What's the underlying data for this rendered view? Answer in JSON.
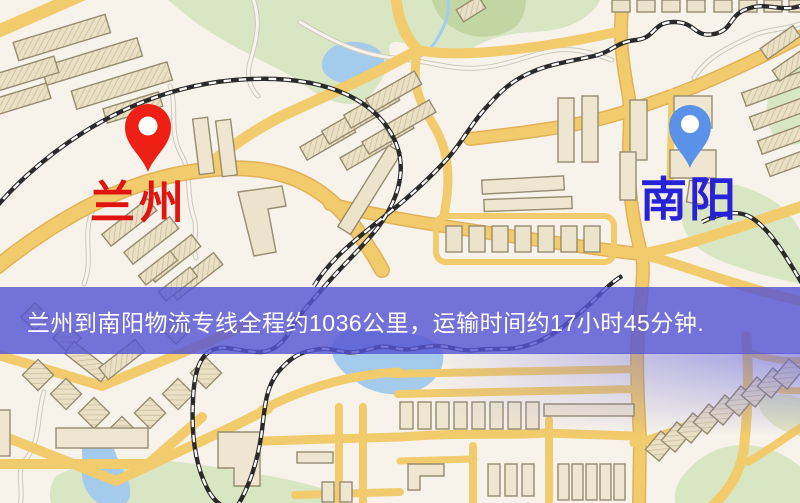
{
  "map": {
    "origin": {
      "label": "兰州",
      "label_color": "#e0150f",
      "pin_color": "#ee2015",
      "pin_icon": "red-location-pin-icon"
    },
    "destination": {
      "label": "南阳",
      "label_color": "#2822d6",
      "pin_color": "#5a92ea",
      "pin_icon": "blue-location-pin-icon"
    },
    "style_colors": {
      "background": "#f7f2ea",
      "road_yellow": "#f2cb6c",
      "park_green": "#d9e6c4",
      "water_blue": "#a5cbec",
      "railway_black": "#2a2a2a"
    }
  },
  "banner": {
    "text": "兰州到南阳物流专线全程约1036公里，运输时间约17小时45分钟.",
    "background": "#5656d4",
    "text_color": "#ffffff"
  }
}
